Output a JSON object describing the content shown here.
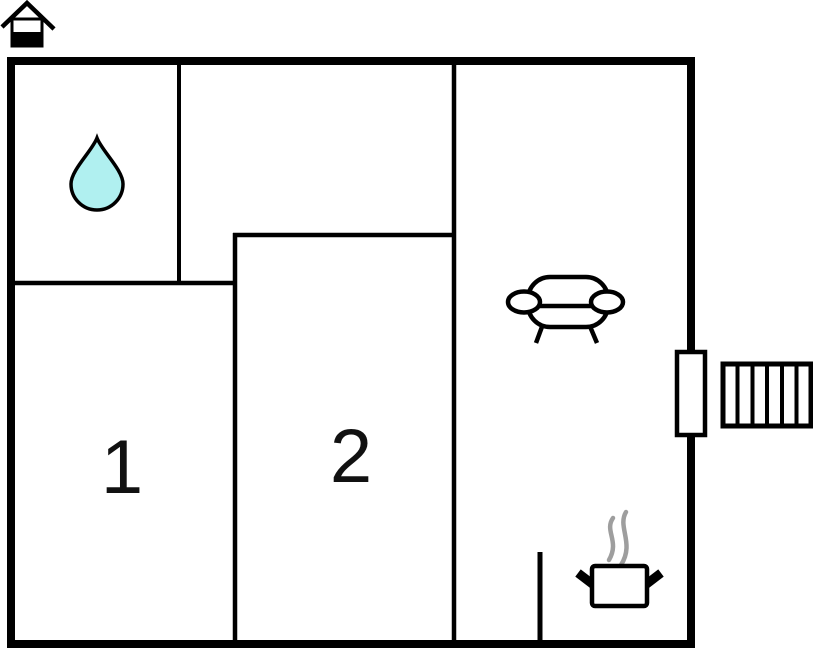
{
  "floorplan": {
    "diagram_type": "floor-plan",
    "rooms": [
      {
        "name": "bathroom",
        "label": ""
      },
      {
        "name": "room-1",
        "label": "1"
      },
      {
        "name": "room-2",
        "label": "2"
      },
      {
        "name": "living-room-kitchen",
        "label": ""
      }
    ],
    "icons": [
      {
        "name": "house-icon"
      },
      {
        "name": "water-drop-icon"
      },
      {
        "name": "sofa-icon"
      },
      {
        "name": "cooking-pot-icon"
      },
      {
        "name": "steam-icon"
      },
      {
        "name": "door-icon"
      },
      {
        "name": "stairs-icon"
      }
    ],
    "colors": {
      "wall": "#000000",
      "water_drop_fill": "#b0f0f0",
      "steam": "#9e9e9e",
      "background": "#ffffff"
    }
  }
}
